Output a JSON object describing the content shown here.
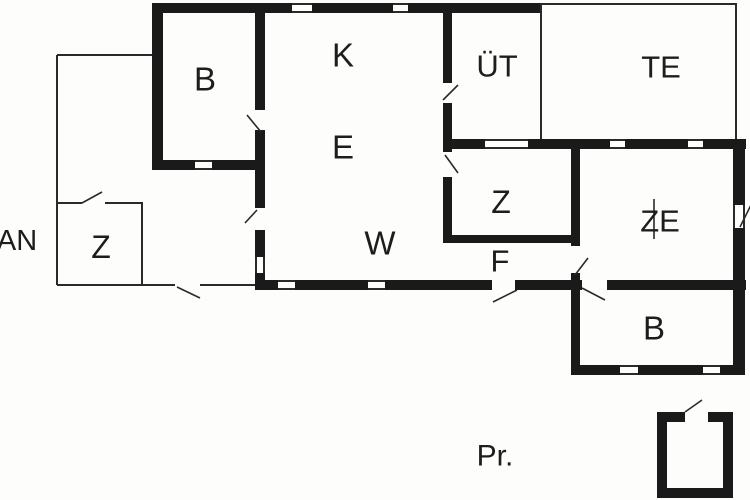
{
  "floorplan": {
    "background": "#fdfdfb",
    "wall_color": "#1a1a1a",
    "thin_color": "#2a2a2a",
    "thin_width": 2,
    "swing_width": 1.6,
    "walls": [
      [
        152,
        3,
        390,
        10
      ],
      [
        152,
        3,
        11,
        167
      ],
      [
        152,
        160,
        113,
        10
      ],
      [
        255,
        3,
        10,
        287
      ],
      [
        255,
        280,
        491,
        10
      ],
      [
        443,
        3,
        9,
        145
      ],
      [
        443,
        139,
        303,
        10
      ],
      [
        443,
        148,
        9,
        95
      ],
      [
        443,
        235,
        137,
        8
      ],
      [
        571,
        148,
        9,
        142
      ],
      [
        571,
        290,
        9,
        85
      ],
      [
        733,
        139,
        12,
        236
      ],
      [
        571,
        365,
        174,
        10
      ],
      [
        657,
        412,
        76,
        10
      ],
      [
        657,
        412,
        10,
        86
      ],
      [
        723,
        412,
        10,
        86
      ],
      [
        657,
        488,
        76,
        10
      ]
    ],
    "thin_lines": [
      [
        57,
        55,
        57,
        285
      ],
      [
        57,
        55,
        152,
        55
      ],
      [
        57,
        285,
        255,
        285
      ],
      [
        57,
        203,
        143,
        203
      ],
      [
        142,
        203,
        142,
        285
      ],
      [
        541,
        4,
        541,
        139
      ],
      [
        541,
        4,
        737,
        4
      ],
      [
        736,
        4,
        736,
        139
      ]
    ],
    "doors": [
      [
        255,
        110,
        10,
        20
      ],
      [
        443,
        83,
        9,
        20
      ],
      [
        443,
        152,
        9,
        25
      ],
      [
        255,
        208,
        10,
        22
      ],
      [
        571,
        246,
        9,
        27
      ],
      [
        492,
        280,
        23,
        10
      ],
      [
        582,
        280,
        25,
        10
      ],
      [
        175,
        282,
        25,
        6
      ],
      [
        82,
        200,
        23,
        6
      ],
      [
        685,
        412,
        23,
        11
      ]
    ],
    "windows": [
      {
        "rect": [
          292,
          3,
          20,
          10
        ],
        "dir": "h"
      },
      {
        "rect": [
          393,
          3,
          15,
          10
        ],
        "dir": "h"
      },
      {
        "rect": [
          195,
          160,
          17,
          10
        ],
        "dir": "h"
      },
      {
        "rect": [
          485,
          139,
          43,
          10
        ],
        "dir": "h"
      },
      {
        "rect": [
          610,
          139,
          15,
          10
        ],
        "dir": "h"
      },
      {
        "rect": [
          688,
          139,
          15,
          10
        ],
        "dir": "h"
      },
      {
        "rect": [
          255,
          257,
          10,
          16
        ],
        "dir": "v"
      },
      {
        "rect": [
          278,
          280,
          17,
          10
        ],
        "dir": "h"
      },
      {
        "rect": [
          368,
          280,
          17,
          10
        ],
        "dir": "h"
      },
      {
        "rect": [
          620,
          365,
          18,
          10
        ],
        "dir": "h"
      },
      {
        "rect": [
          703,
          365,
          17,
          10
        ],
        "dir": "h"
      },
      {
        "rect": [
          733,
          205,
          12,
          23
        ],
        "dir": "v"
      }
    ],
    "swings": [
      [
        247,
        115,
        261,
        132
      ],
      [
        443,
        100,
        458,
        85
      ],
      [
        445,
        155,
        458,
        173
      ],
      [
        257,
        210,
        245,
        223
      ],
      [
        575,
        275,
        588,
        258
      ],
      [
        493,
        302,
        517,
        290
      ],
      [
        582,
        288,
        605,
        300
      ],
      [
        82,
        203,
        102,
        192
      ],
      [
        177,
        287,
        200,
        298
      ],
      [
        685,
        412,
        702,
        400
      ],
      [
        740,
        227,
        752,
        203
      ],
      [
        654,
        199,
        654,
        239
      ]
    ],
    "labels": [
      {
        "name": "room-label-annex",
        "text": "AN",
        "x": 17,
        "y": 241,
        "size": 29
      },
      {
        "name": "room-label-annex-z",
        "text": "Z",
        "x": 101,
        "y": 247,
        "size": 32
      },
      {
        "name": "room-label-b-topleft",
        "text": "B",
        "x": 205,
        "y": 79,
        "size": 33
      },
      {
        "name": "room-label-k",
        "text": "K",
        "x": 343,
        "y": 55,
        "size": 33
      },
      {
        "name": "room-label-e",
        "text": "E",
        "x": 343,
        "y": 147,
        "size": 33
      },
      {
        "name": "room-label-w",
        "text": "W",
        "x": 380,
        "y": 243,
        "size": 33
      },
      {
        "name": "room-label-ut",
        "text": "ÜT",
        "x": 497,
        "y": 66,
        "size": 31
      },
      {
        "name": "room-label-te",
        "text": "TE",
        "x": 661,
        "y": 67,
        "size": 31
      },
      {
        "name": "room-label-z-inner",
        "text": "Z",
        "x": 501,
        "y": 202,
        "size": 32
      },
      {
        "name": "room-label-f",
        "text": "F",
        "x": 500,
        "y": 261,
        "size": 31
      },
      {
        "name": "room-label-ze",
        "text": "ZE",
        "x": 660,
        "y": 221,
        "size": 31
      },
      {
        "name": "room-label-b-bottomright",
        "text": "B",
        "x": 654,
        "y": 328,
        "size": 33
      },
      {
        "name": "outdoor-label-pr",
        "text": "Pr.",
        "x": 495,
        "y": 456,
        "size": 30
      }
    ]
  }
}
